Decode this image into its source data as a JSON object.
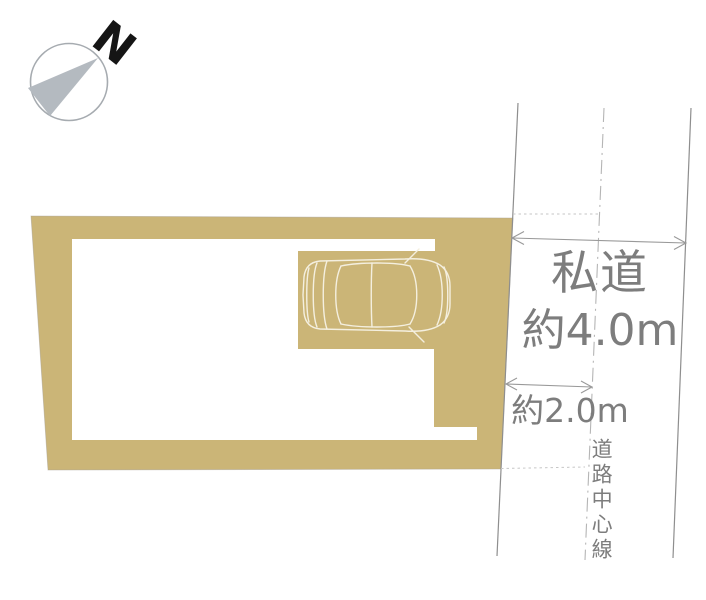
{
  "compass": {
    "north_label": "N"
  },
  "road": {
    "name": "私道",
    "width_label": "約4.0m",
    "half_width_label": "約2.0m",
    "centerline_label": "道路中心線"
  },
  "colors": {
    "plot_fill": "#cbb577",
    "plot_outline": "#a8a193",
    "label_text": "#7d7d7d",
    "road_line": "#8e8e8e",
    "centerline": "#b5b5b5",
    "guide_dash": "#c6c6c6",
    "arrow": "#999999",
    "compass_needle": "#b4bac0",
    "compass_ring": "#a6abb0",
    "car_outline": "#f4efdf"
  }
}
